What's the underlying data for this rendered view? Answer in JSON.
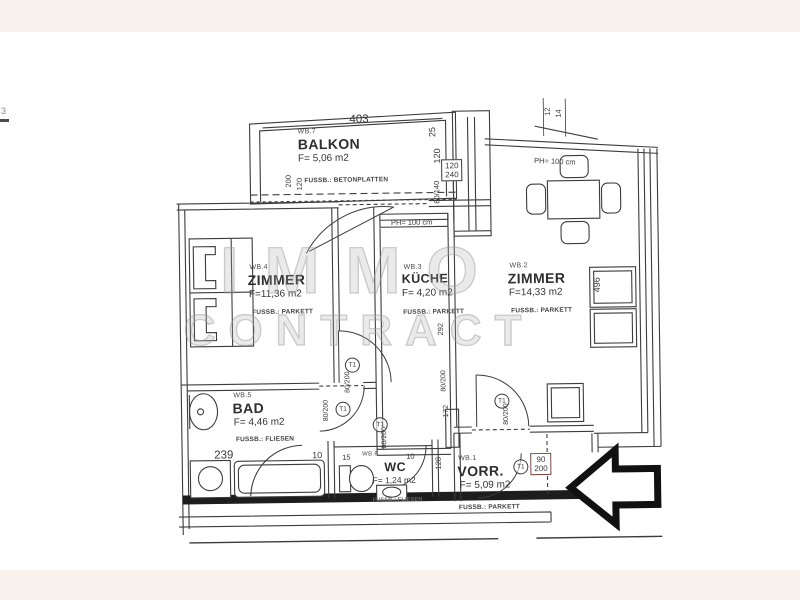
{
  "colors": {
    "page_bg": "#f7f3ec",
    "paper": "#ffffff",
    "ink": "#383838",
    "thick_wall": "#1d1d1d",
    "watermark": "#adadad"
  },
  "watermark": {
    "line1": "IMMO",
    "line2": "CONTRACT"
  },
  "artifacts": {
    "left_edge_mark": "3"
  },
  "rooms": {
    "balkon": {
      "code": "WB.7",
      "name": "BALKON",
      "area": "F= 5,06 m2",
      "floor": "FUSSB.: BETONPLATTEN"
    },
    "zimmer_links": {
      "code": "WB.4",
      "name": "ZIMMER",
      "area": "F=11,36 m2",
      "floor": "FUSSB.: PARKETT"
    },
    "kueche": {
      "code": "WB.3",
      "name": "KÜCHE",
      "area": "F= 4,20 m2",
      "floor": "FUSSB.: PARKETT"
    },
    "zimmer_rechts": {
      "code": "WB.2",
      "name": "ZIMMER",
      "area": "F=14,33 m2",
      "floor": "FUSSB.: PARKETT"
    },
    "bad": {
      "code": "WB.5",
      "name": "BAD",
      "area": "F= 4,46 m2",
      "floor": "FUSSB.: FLIESEN"
    },
    "wc": {
      "code": "WB.6",
      "name": "WC",
      "area": "F= 1,24 m2",
      "floor": "FUSSB.: FLIESEN"
    },
    "vorraum": {
      "code": "WB.1",
      "name": "VORR.",
      "area": "F= 5,09 m2",
      "floor": "FUSSB.: PARKETT"
    }
  },
  "dims": {
    "balkon_length": "403",
    "balkon_d25": "25",
    "balkon_d120": "120",
    "window_sill": "120",
    "window_height": "240",
    "window_80_140": "80/140",
    "corner_12": "12",
    "corner_14": "14",
    "parapet_a": "PH= 100 cm",
    "parapet_b": "PH= 100 cm",
    "balcony_door_w": "200",
    "balcony_door_h": "120",
    "room_right_length": "496",
    "kitchen_length": "292",
    "hall_d172": "172",
    "hall_d128": "128",
    "bad_width": "239",
    "wall_d10_a": "10",
    "bad_d15": "15",
    "wall_d10_b": "10",
    "door_std": "80/200",
    "door_entrance_w": "90",
    "door_entrance_h": "200",
    "door_tag": "T1"
  }
}
